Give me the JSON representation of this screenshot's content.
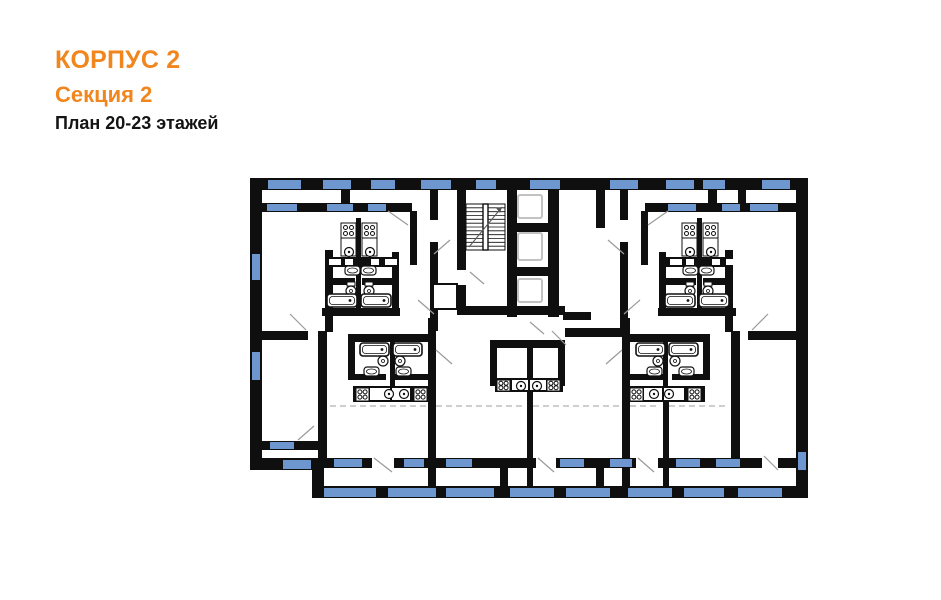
{
  "header": {
    "building": "КОРПУС 2",
    "section": "Секция 2",
    "plan_label": "План 20-23 этажей"
  },
  "colors": {
    "accent": "#F0861D",
    "text": "#141414",
    "wall": "#0f0f0f",
    "window": "#6F97CF",
    "door_line": "#9a9a9a",
    "dash_line": "#bdbdbd",
    "fixture_stroke": "#111111",
    "fixture_fill": "#ffffff",
    "elevator_car": "#c2c2c2"
  },
  "floorplan": {
    "walls": [
      [
        250,
        178,
        558,
        12
      ],
      [
        250,
        190,
        12,
        280
      ],
      [
        250,
        458,
        72,
        12
      ],
      [
        312,
        458,
        12,
        40
      ],
      [
        312,
        486,
        496,
        12
      ],
      [
        796,
        190,
        12,
        308
      ],
      [
        262,
        441,
        60,
        9
      ],
      [
        262,
        203,
        150,
        9
      ],
      [
        645,
        203,
        153,
        9
      ],
      [
        738,
        203,
        58,
        9
      ],
      [
        341,
        178,
        9,
        34
      ],
      [
        708,
        178,
        9,
        34
      ],
      [
        738,
        178,
        8,
        34
      ],
      [
        410,
        211,
        7,
        54
      ],
      [
        430,
        178,
        8,
        42
      ],
      [
        430,
        242,
        8,
        89
      ],
      [
        325,
        250,
        8,
        82
      ],
      [
        392,
        252,
        7,
        60
      ],
      [
        356,
        218,
        5,
        96
      ],
      [
        322,
        308,
        78,
        8
      ],
      [
        641,
        211,
        7,
        54
      ],
      [
        620,
        178,
        8,
        42
      ],
      [
        620,
        242,
        8,
        89
      ],
      [
        725,
        250,
        8,
        82
      ],
      [
        659,
        252,
        7,
        60
      ],
      [
        697,
        218,
        5,
        96
      ],
      [
        658,
        308,
        78,
        8
      ],
      [
        457,
        190,
        9,
        80
      ],
      [
        457,
        285,
        9,
        30
      ],
      [
        507,
        178,
        10,
        139
      ],
      [
        548,
        190,
        11,
        127
      ],
      [
        517,
        223,
        31,
        9
      ],
      [
        517,
        267,
        31,
        9
      ],
      [
        457,
        306,
        42,
        9
      ],
      [
        490,
        306,
        75,
        9
      ],
      [
        596,
        178,
        9,
        50
      ],
      [
        563,
        312,
        28,
        8
      ],
      [
        262,
        331,
        46,
        9
      ],
      [
        318,
        331,
        9,
        127
      ],
      [
        348,
        334,
        84,
        8
      ],
      [
        490,
        340,
        74,
        8
      ],
      [
        565,
        328,
        58,
        9
      ],
      [
        626,
        334,
        84,
        8
      ],
      [
        731,
        331,
        9,
        127
      ],
      [
        748,
        331,
        48,
        9
      ],
      [
        348,
        334,
        7,
        46
      ],
      [
        390,
        340,
        5,
        46
      ],
      [
        352,
        374,
        34,
        6
      ],
      [
        392,
        374,
        38,
        6
      ],
      [
        703,
        334,
        7,
        46
      ],
      [
        663,
        340,
        5,
        46
      ],
      [
        628,
        374,
        38,
        6
      ],
      [
        672,
        374,
        34,
        6
      ],
      [
        490,
        340,
        7,
        46
      ],
      [
        558,
        340,
        7,
        46
      ],
      [
        527,
        340,
        6,
        146
      ],
      [
        428,
        318,
        8,
        168
      ],
      [
        622,
        318,
        8,
        168
      ],
      [
        663,
        386,
        6,
        100
      ],
      [
        500,
        458,
        8,
        40
      ],
      [
        596,
        458,
        8,
        40
      ],
      [
        322,
        458,
        474,
        10
      ],
      [
        325,
        278,
        30,
        7
      ],
      [
        362,
        278,
        30,
        7
      ],
      [
        666,
        278,
        30,
        7
      ],
      [
        703,
        278,
        30,
        7
      ]
    ],
    "windows": [
      [
        268,
        180,
        33,
        9
      ],
      [
        323,
        180,
        28,
        9
      ],
      [
        371,
        180,
        24,
        9
      ],
      [
        421,
        180,
        30,
        9
      ],
      [
        476,
        180,
        20,
        9
      ],
      [
        530,
        180,
        30,
        9
      ],
      [
        610,
        180,
        28,
        9
      ],
      [
        666,
        180,
        28,
        9
      ],
      [
        703,
        180,
        22,
        9
      ],
      [
        762,
        180,
        28,
        9
      ],
      [
        267,
        204,
        30,
        7
      ],
      [
        327,
        204,
        26,
        7
      ],
      [
        368,
        204,
        18,
        7
      ],
      [
        668,
        204,
        28,
        7
      ],
      [
        722,
        204,
        18,
        7
      ],
      [
        750,
        204,
        28,
        7
      ],
      [
        252,
        254,
        8,
        26
      ],
      [
        252,
        352,
        8,
        28
      ],
      [
        270,
        442,
        24,
        7
      ],
      [
        283,
        460,
        28,
        9
      ],
      [
        798,
        452,
        8,
        18
      ],
      [
        334,
        459,
        28,
        8
      ],
      [
        404,
        459,
        20,
        8
      ],
      [
        446,
        459,
        26,
        8
      ],
      [
        560,
        459,
        24,
        8
      ],
      [
        610,
        459,
        22,
        8
      ],
      [
        676,
        459,
        24,
        8
      ],
      [
        716,
        459,
        24,
        8
      ],
      [
        324,
        488,
        52,
        9
      ],
      [
        388,
        488,
        48,
        9
      ],
      [
        446,
        488,
        48,
        9
      ],
      [
        510,
        488,
        44,
        9
      ],
      [
        566,
        488,
        44,
        9
      ],
      [
        628,
        488,
        44,
        9
      ],
      [
        684,
        488,
        40,
        9
      ],
      [
        738,
        488,
        44,
        9
      ]
    ],
    "door_gaps": [
      [
        372,
        456,
        22,
        14
      ],
      [
        536,
        456,
        20,
        14
      ],
      [
        636,
        456,
        22,
        14
      ],
      [
        762,
        456,
        16,
        14
      ]
    ],
    "door_lines": [
      [
        374,
        458,
        392,
        472
      ],
      [
        538,
        458,
        554,
        472
      ],
      [
        638,
        458,
        654,
        472
      ],
      [
        764,
        456,
        778,
        470
      ],
      [
        388,
        211,
        408,
        225
      ],
      [
        668,
        211,
        648,
        225
      ],
      [
        306,
        330,
        290,
        314
      ],
      [
        752,
        330,
        768,
        314
      ],
      [
        434,
        254,
        450,
        240
      ],
      [
        624,
        254,
        608,
        240
      ],
      [
        436,
        350,
        452,
        364
      ],
      [
        622,
        350,
        606,
        364
      ],
      [
        298,
        440,
        314,
        426
      ],
      [
        470,
        272,
        484,
        284
      ],
      [
        552,
        331,
        566,
        345
      ],
      [
        418,
        300,
        434,
        314
      ],
      [
        640,
        300,
        624,
        314
      ],
      [
        530,
        322,
        544,
        334
      ]
    ],
    "dashed_lines": [
      [
        330,
        406,
        426,
        406
      ],
      [
        436,
        406,
        524,
        406
      ],
      [
        533,
        406,
        620,
        406
      ],
      [
        630,
        406,
        660,
        406
      ],
      [
        669,
        406,
        728,
        406
      ]
    ],
    "stair": {
      "box": [
        466,
        204,
        39,
        46
      ],
      "tread_count": 12,
      "rail": [
        483,
        204,
        5,
        46
      ],
      "arrow": [
        469,
        247,
        502,
        207
      ]
    },
    "elevator_cars": [
      [
        518,
        195,
        24,
        23
      ],
      [
        518,
        233,
        24,
        27
      ],
      [
        518,
        279,
        24,
        23
      ]
    ],
    "closet": [
      433,
      284,
      24,
      25
    ],
    "counters": [
      [
        325,
        257,
        67,
        10
      ],
      [
        666,
        257,
        67,
        10
      ],
      [
        353,
        386,
        78,
        16
      ],
      [
        627,
        386,
        78,
        16
      ],
      [
        495,
        378,
        68,
        14
      ]
    ],
    "counter_cells": [
      [
        329,
        259,
        12,
        6
      ],
      [
        345,
        259,
        8,
        6
      ],
      [
        371,
        259,
        8,
        6
      ],
      [
        385,
        259,
        12,
        6
      ],
      [
        670,
        259,
        12,
        6
      ],
      [
        686,
        259,
        8,
        6
      ],
      [
        712,
        259,
        8,
        6
      ],
      [
        726,
        259,
        12,
        6
      ],
      [
        370,
        388,
        20,
        12
      ],
      [
        392,
        388,
        18,
        12
      ],
      [
        644,
        388,
        18,
        12
      ],
      [
        664,
        388,
        20,
        12
      ],
      [
        512,
        380,
        16,
        10
      ],
      [
        530,
        380,
        16,
        10
      ]
    ],
    "cabinets": [
      [
        341,
        238,
        15,
        18
      ],
      [
        362,
        238,
        15,
        18
      ],
      [
        682,
        238,
        15,
        18
      ],
      [
        703,
        238,
        15,
        18
      ]
    ],
    "stoves": [
      [
        341,
        223,
        15,
        15
      ],
      [
        362,
        223,
        15,
        15
      ],
      [
        682,
        223,
        15,
        15
      ],
      [
        703,
        223,
        15,
        15
      ],
      [
        356,
        388,
        13,
        13
      ],
      [
        414,
        388,
        13,
        13
      ],
      [
        630,
        388,
        13,
        13
      ],
      [
        688,
        388,
        13,
        13
      ],
      [
        497,
        380,
        13,
        11
      ],
      [
        547,
        380,
        13,
        11
      ]
    ],
    "sinks": [
      [
        349,
        252
      ],
      [
        370,
        252
      ],
      [
        690,
        252
      ],
      [
        711,
        252
      ],
      [
        389,
        394
      ],
      [
        404,
        394
      ],
      [
        654,
        394
      ],
      [
        669,
        394
      ],
      [
        521,
        386
      ],
      [
        537,
        386
      ]
    ],
    "basins": [
      [
        345,
        266,
        15,
        9
      ],
      [
        361,
        266,
        15,
        9
      ],
      [
        683,
        266,
        15,
        9
      ],
      [
        699,
        266,
        15,
        9
      ],
      [
        364,
        367,
        15,
        9
      ],
      [
        396,
        367,
        15,
        9
      ],
      [
        647,
        367,
        15,
        9
      ],
      [
        679,
        367,
        15,
        9
      ]
    ],
    "toilets": [
      [
        351,
        291
      ],
      [
        369,
        291
      ],
      [
        690,
        291
      ],
      [
        708,
        291
      ],
      [
        383,
        361
      ],
      [
        400,
        361
      ],
      [
        658,
        361
      ],
      [
        675,
        361
      ]
    ],
    "tubs": [
      [
        327,
        294,
        30,
        13
      ],
      [
        361,
        294,
        30,
        13
      ],
      [
        665,
        294,
        30,
        13
      ],
      [
        699,
        294,
        30,
        13
      ],
      [
        360,
        343,
        29,
        13
      ],
      [
        393,
        343,
        29,
        13
      ],
      [
        636,
        343,
        29,
        13
      ],
      [
        669,
        343,
        29,
        13
      ]
    ]
  }
}
